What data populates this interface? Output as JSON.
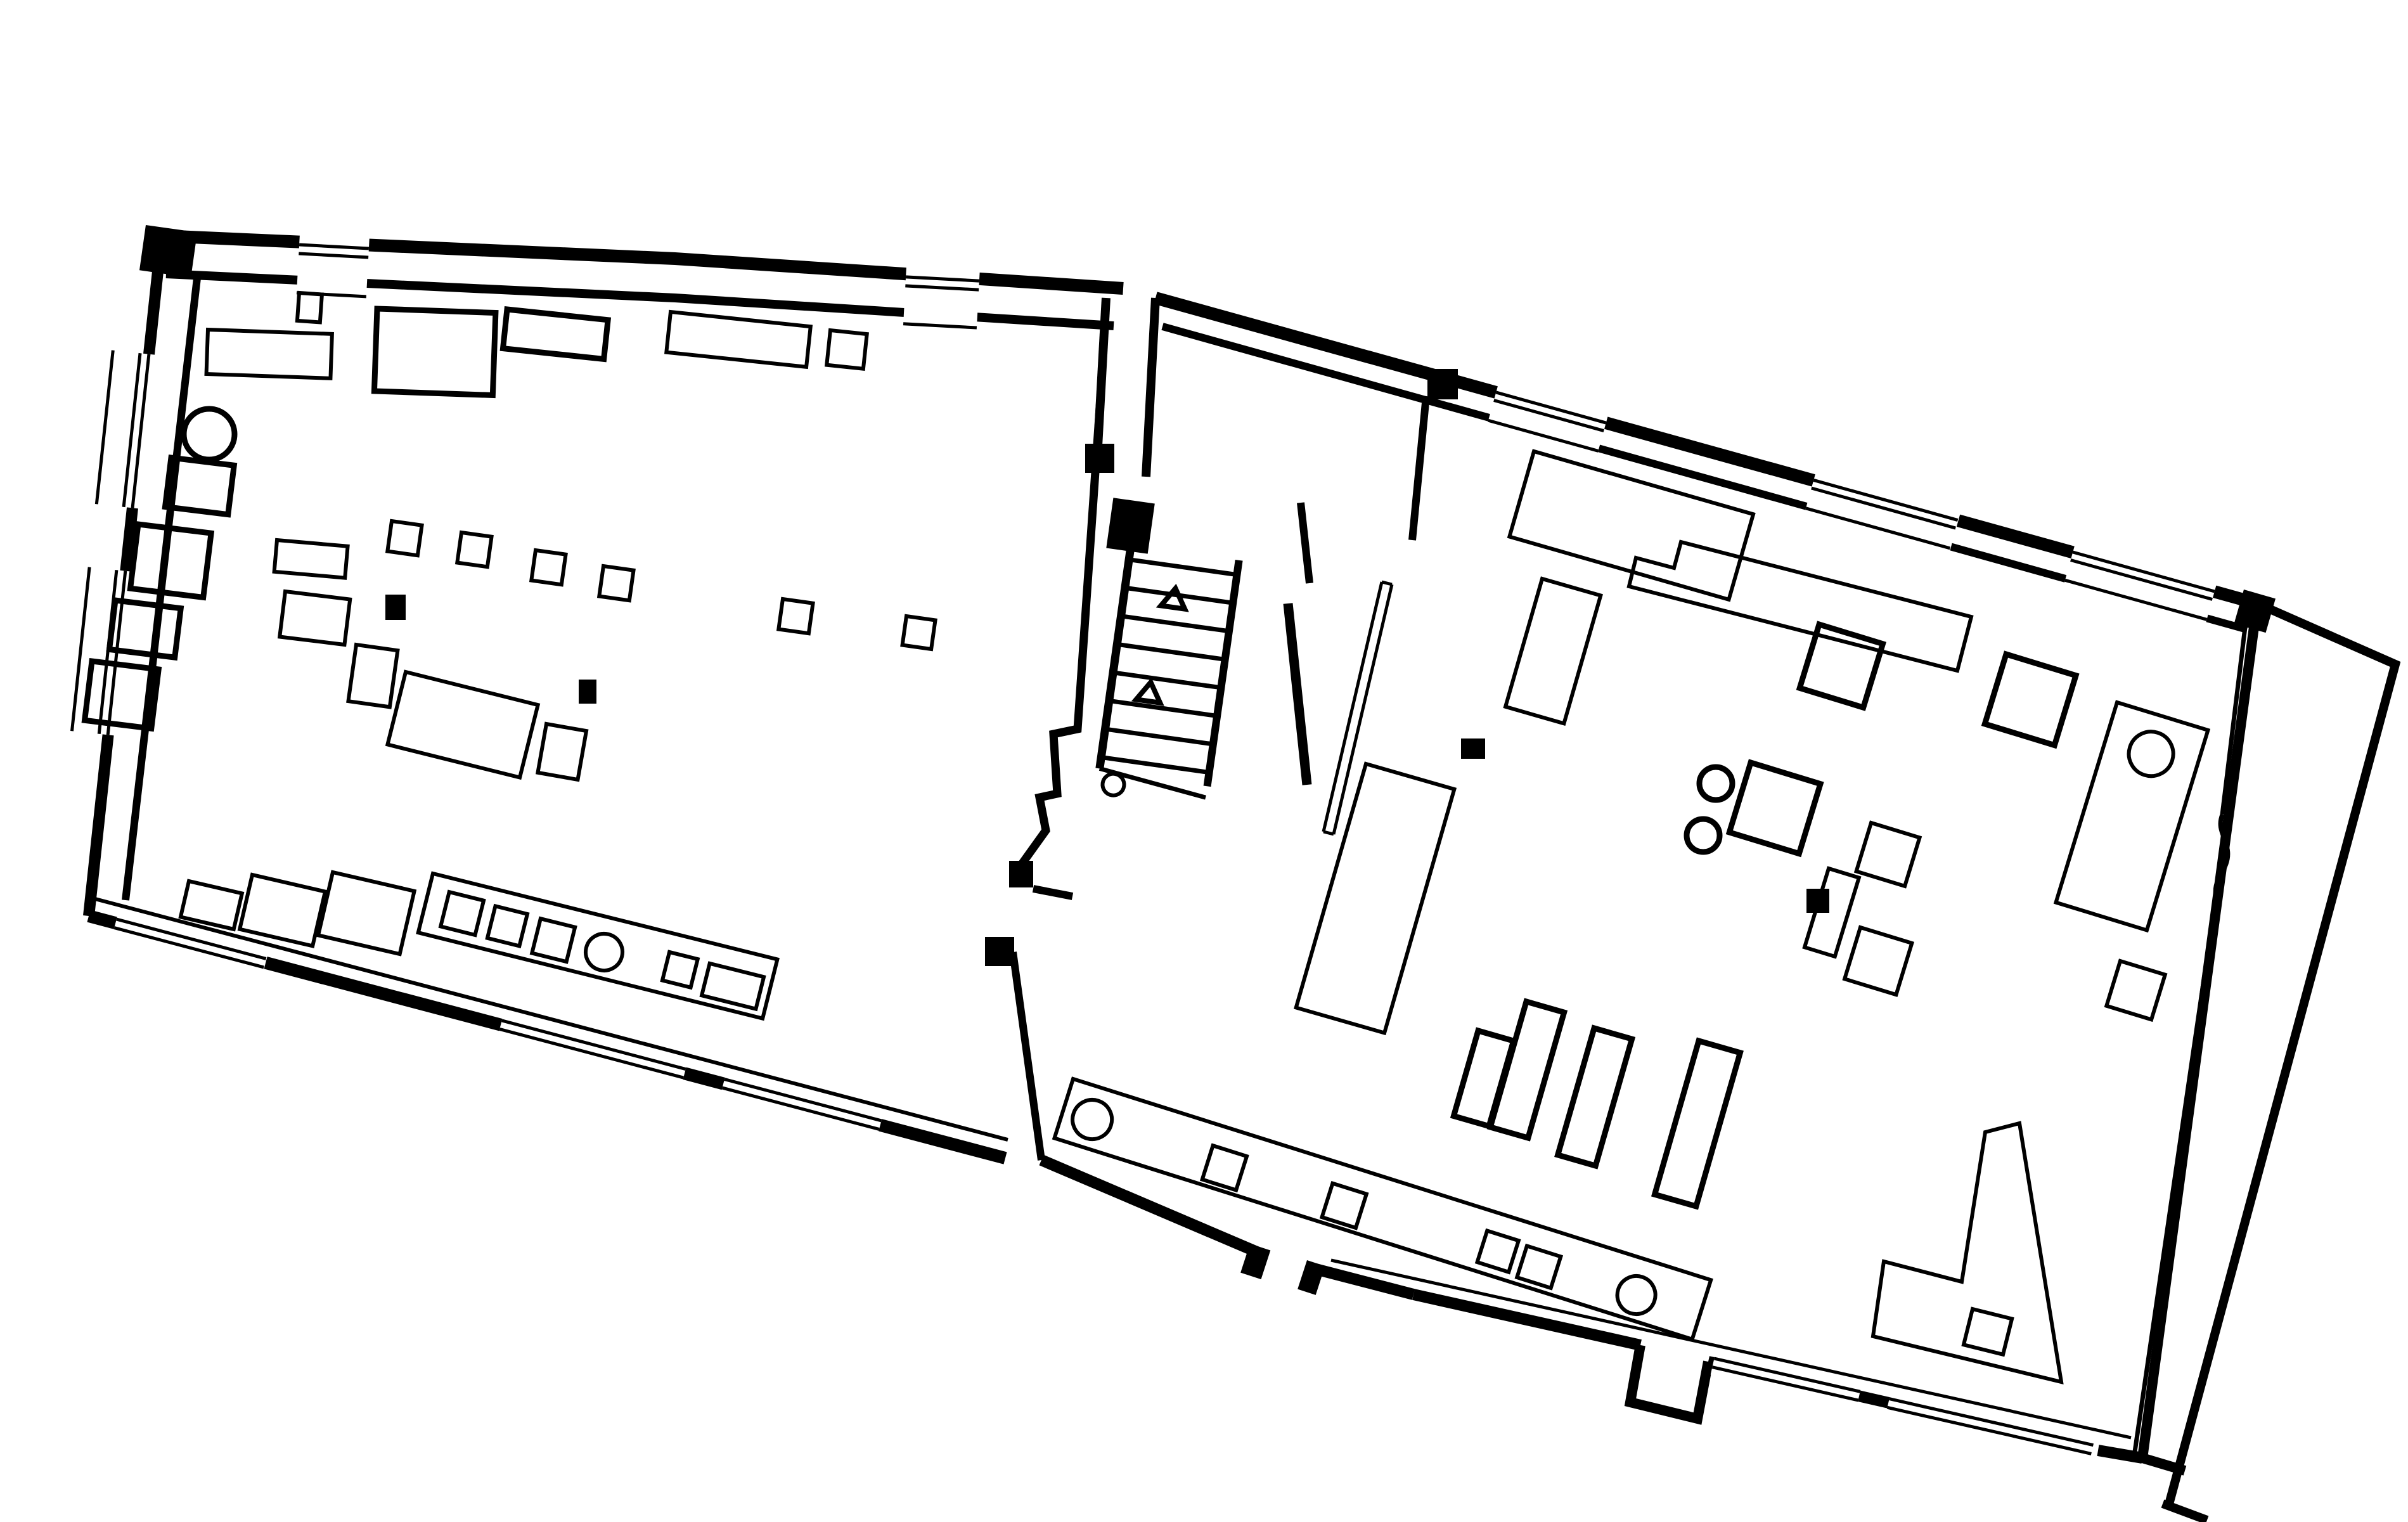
{
  "document": {
    "type": "architectural-floor-plan",
    "visible_text": [],
    "style": "black ink line drawing on white, plan rotated ~15 degrees"
  },
  "drawing": {
    "colors": {
      "ink": "#000000",
      "paper": "#ffffff"
    },
    "stroke_widths": {
      "outer_wall": 20,
      "inner_wall": 13,
      "window_line": 5,
      "furniture": 6,
      "furniture_bold": 9
    },
    "rooms": [
      {
        "id": "left-hall",
        "description": "large hall, window bands on three walls, rows of plinths and tables, service counter with three squares and one circle, two black column posts"
      },
      {
        "id": "stair-hall",
        "description": "central stair enclosure, 8 treads, 2 direction triangles, start circle, thin screen partition at right"
      },
      {
        "id": "right-hall",
        "description": "large hall, window bands top/bottom/right, long counter with 2 circles and 4 squares, bench row of 4, L-shaped counter, desk with circle, two black column posts, entrance bump on bottom wall"
      }
    ],
    "stairs": {
      "treads": 8,
      "direction_triangles": 2,
      "start_circle": 1
    },
    "window_bands": {
      "left_top_wall": 2,
      "left_side_wall": 2,
      "left_bottom_wall": 3,
      "right_top_wall": 3,
      "right_bottom_wall": 2
    },
    "black_posts": 7,
    "circles_total": 8
  }
}
